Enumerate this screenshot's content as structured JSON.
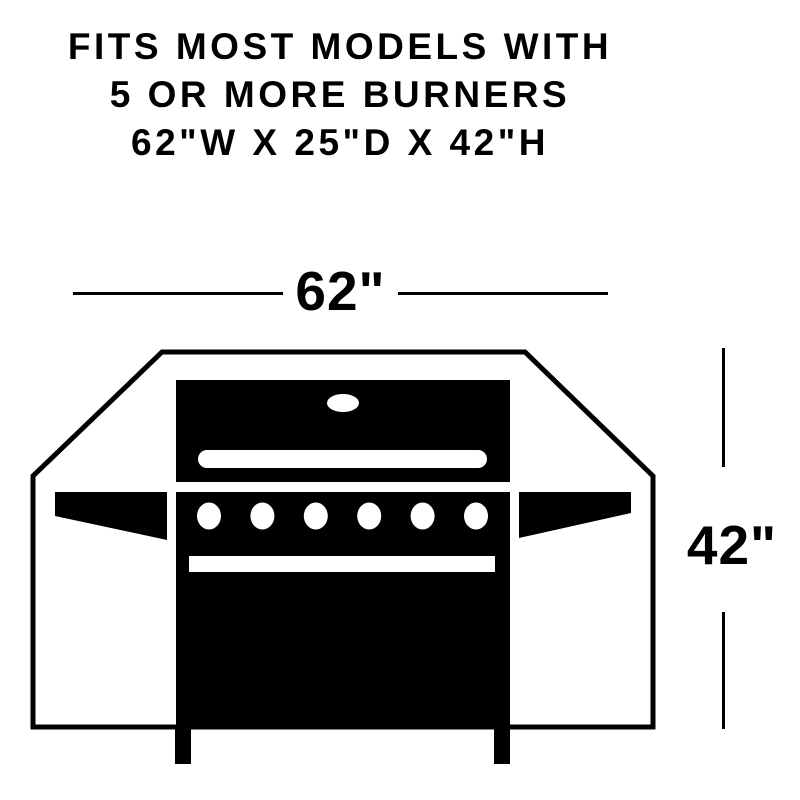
{
  "header": {
    "line1": "FITS MOST MODELS WITH",
    "line2": "5 OR MORE BURNERS",
    "line3": "62\"W X 25\"D X 42\"H"
  },
  "dimensions": {
    "width_label": "62\"",
    "height_label": "42\""
  },
  "grill": {
    "burner_count": 6
  },
  "colors": {
    "ink": "#000000",
    "background": "#ffffff"
  }
}
